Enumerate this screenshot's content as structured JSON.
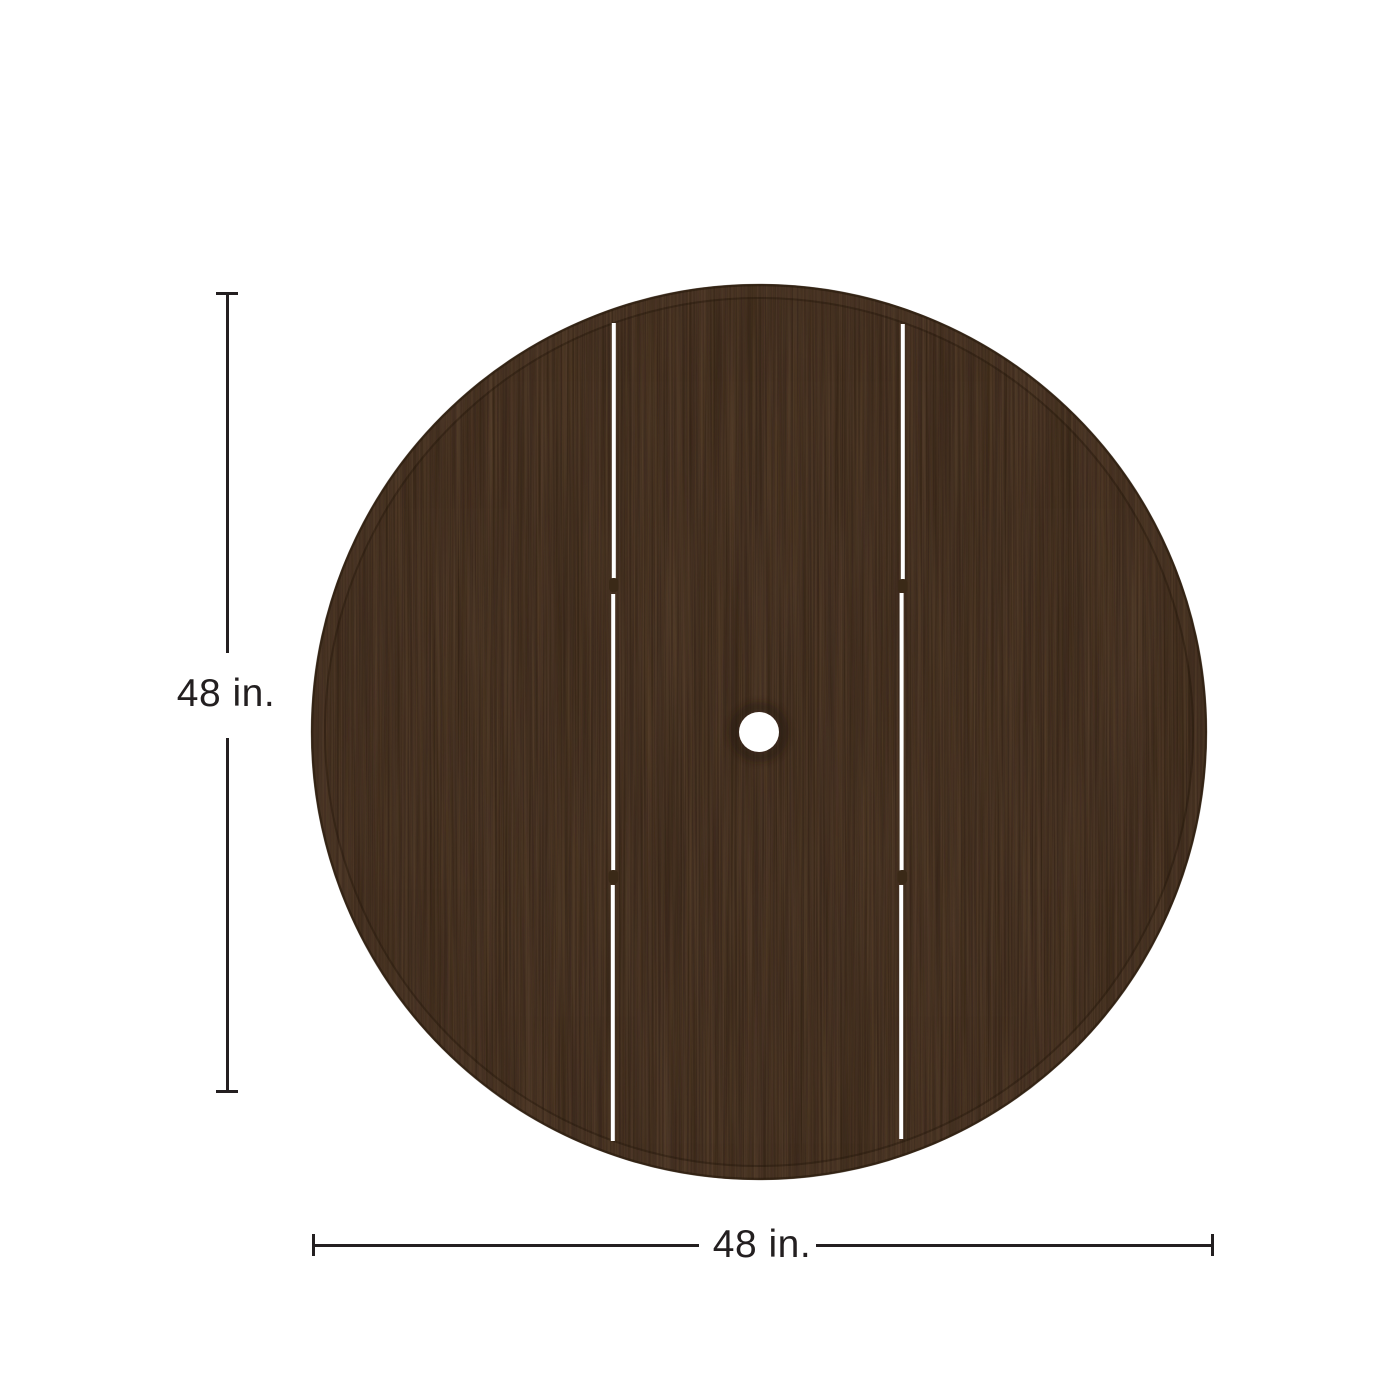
{
  "diagram": {
    "height_dimension": {
      "label": "48 in.",
      "value": 48,
      "unit": "in."
    },
    "width_dimension": {
      "label": "48 in.",
      "value": 48,
      "unit": "in."
    }
  },
  "dimension_style": {
    "line_color": "#231f20",
    "text_color": "#231f20"
  },
  "tabletop": {
    "description": "round-plank-table-top-with-umbrella-hole",
    "planks": 3,
    "colors": {
      "wood_base": "#4a3526",
      "grain_dark": "#2c1d0f",
      "grain_light": "#6b5138",
      "band_dark": "#241709",
      "rim_light": "#5a4430",
      "plank_gap": "#ffffff",
      "notch": "#3a2917",
      "hole": "#ffffff"
    }
  }
}
